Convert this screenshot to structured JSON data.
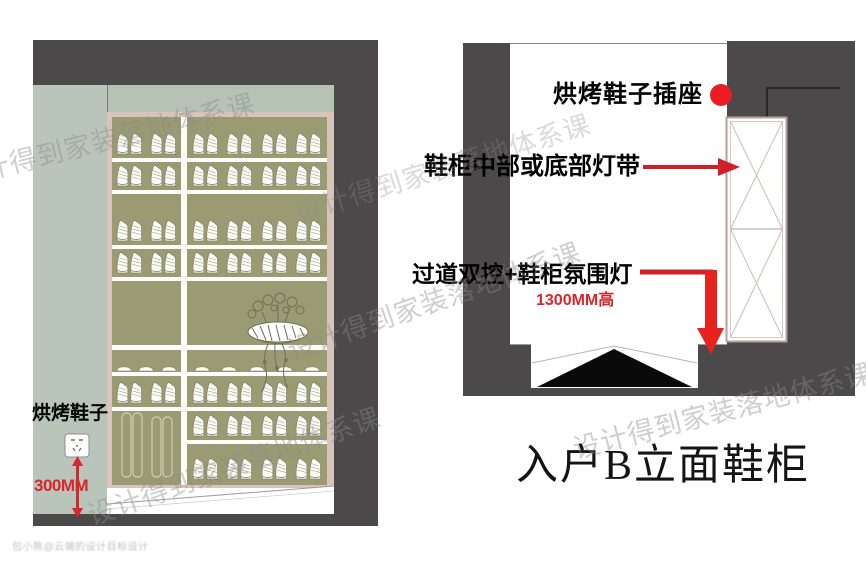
{
  "left_panel": {
    "socket_label": "烘烤鞋子",
    "socket_height_dim": "300MM",
    "cabinet": {
      "left_rows": [
        {
          "kind": "boots",
          "count": 2,
          "bottom": 41
        },
        {
          "kind": "boots",
          "count": 2,
          "bottom": 73
        },
        {
          "kind": "boots",
          "count": 2,
          "bottom": 128
        },
        {
          "kind": "boots",
          "count": 2,
          "bottom": 160
        },
        {
          "kind": "slippers",
          "count": 3,
          "bottom": 255
        },
        {
          "kind": "boots",
          "count": 2,
          "bottom": 290
        },
        {
          "kind": "tallboots",
          "count": 1,
          "bottom": 364
        }
      ],
      "right_rows": [
        {
          "kind": "boots",
          "count": 4,
          "bottom": 41
        },
        {
          "kind": "boots",
          "count": 4,
          "bottom": 73
        },
        {
          "kind": "boots",
          "count": 4,
          "bottom": 128
        },
        {
          "kind": "boots",
          "count": 4,
          "bottom": 160
        },
        {
          "kind": "slippers",
          "count": 5,
          "bottom": 255
        },
        {
          "kind": "boots",
          "count": 4,
          "bottom": 290
        },
        {
          "kind": "boots",
          "count": 4,
          "bottom": 323
        },
        {
          "kind": "boots",
          "count": 4,
          "bottom": 366
        }
      ],
      "shelves_full": [
        41,
        73,
        128,
        160,
        228,
        255,
        290
      ],
      "shelves_right": [
        323
      ]
    }
  },
  "right_panel": {
    "socket_annotation": "烘烤鞋子插座",
    "led_annotation": "鞋柜中部或底部灯带",
    "switch_annotation": "过道双控+鞋柜氛围灯",
    "height_dim": "1300MM高",
    "title": "入户B立面鞋柜"
  },
  "watermark": {
    "diagonal_text": "设计得到家装落地体系课",
    "corner_text": "包小熊@云端的设计目标设计"
  },
  "colors": {
    "wall_dark": "#4b4949",
    "wall_pale": "#b9c5ba",
    "cabinet_frame": "#d9c4bb",
    "cabinet_interior": "#9a9b73",
    "accent_red": "#e8231f",
    "annotation_red": "#cc2127",
    "dim_red": "#d8262c"
  }
}
